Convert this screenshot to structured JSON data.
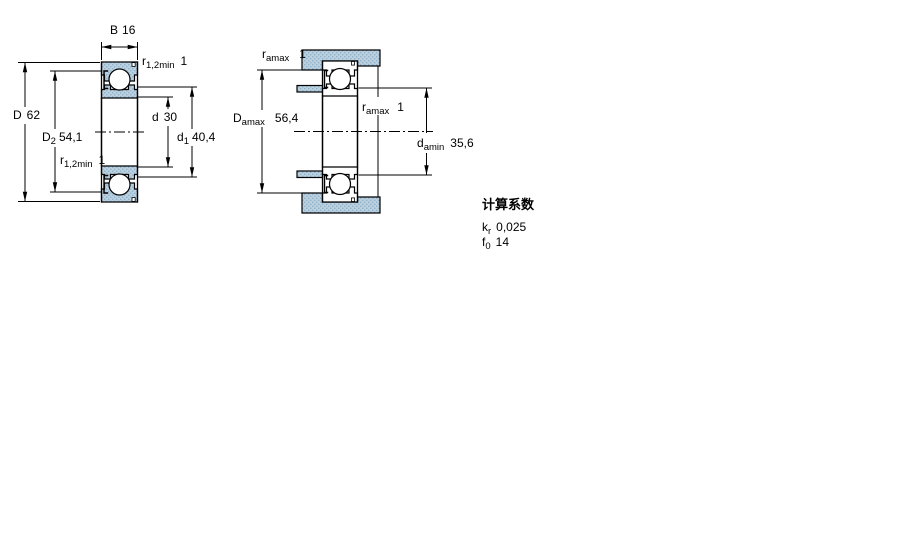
{
  "page": {
    "background": "#ffffff"
  },
  "drawing": {
    "fill_color": "#bdd0de",
    "dot_color": "#8fb2cd",
    "line_color": "#000000",
    "left_view": {
      "dim_B": {
        "symbol": "B",
        "value": "16"
      },
      "dim_r12_top": {
        "symbol": "r",
        "sub": "1,2min",
        "value": "1"
      },
      "dim_D": {
        "symbol": "D",
        "value": "62"
      },
      "dim_D2": {
        "symbol": "D",
        "sub": "2",
        "value": "54,1"
      },
      "dim_r12_bottom": {
        "symbol": "r",
        "sub": "1,2min",
        "value": "1"
      },
      "dim_d": {
        "symbol": "d",
        "value": "30"
      },
      "dim_d1": {
        "symbol": "d",
        "sub": "1",
        "value": "40,4"
      }
    },
    "right_view": {
      "dim_ra_top": {
        "symbol": "r",
        "sub": "amax",
        "value": "1"
      },
      "dim_Da": {
        "symbol": "D",
        "sub": "amax",
        "value": "56,4"
      },
      "dim_ra_mid": {
        "symbol": "r",
        "sub": "amax",
        "value": "1"
      },
      "dim_da": {
        "symbol": "d",
        "sub": "amin",
        "value": "35,6"
      }
    },
    "calc_factors": {
      "title": "计算系数",
      "rows": [
        {
          "symbol": "k",
          "sub": "r",
          "value": "0,025"
        },
        {
          "symbol": "f",
          "sub": "0",
          "value": "14"
        }
      ]
    }
  }
}
